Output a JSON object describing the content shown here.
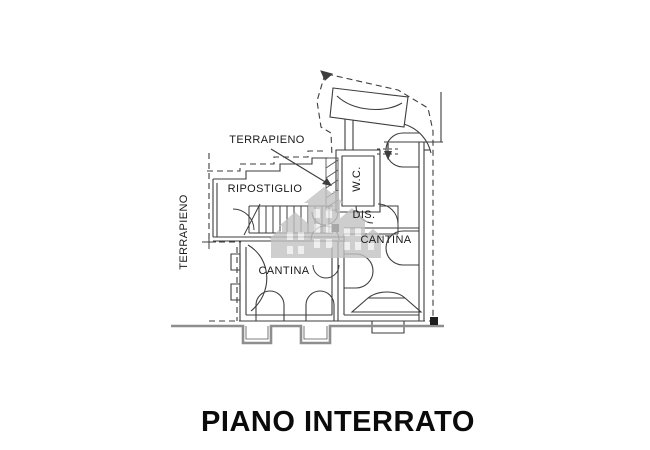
{
  "title": {
    "text": "PIANO INTERRATO"
  },
  "rooms": {
    "terrapieno_top": {
      "label": "TERRAPIENO"
    },
    "terrapieno_left": {
      "label": "TERRAPIENO"
    },
    "ripostiglio": {
      "label": "RIPOSTIGLIO"
    },
    "wc": {
      "label": "W.C."
    },
    "dis": {
      "label": "DIS."
    },
    "cantina_upper": {
      "label": "CANTINA"
    },
    "cantina_lower": {
      "label": "CANTINA"
    }
  },
  "watermark": {
    "name": "houses-skyline-logo"
  },
  "colors": {
    "line": "#3d3d3d",
    "ground_line": "#8e8e8e",
    "watermark": "#c2c2c2",
    "background": "#ffffff",
    "title_text": "#0b0b0b"
  }
}
